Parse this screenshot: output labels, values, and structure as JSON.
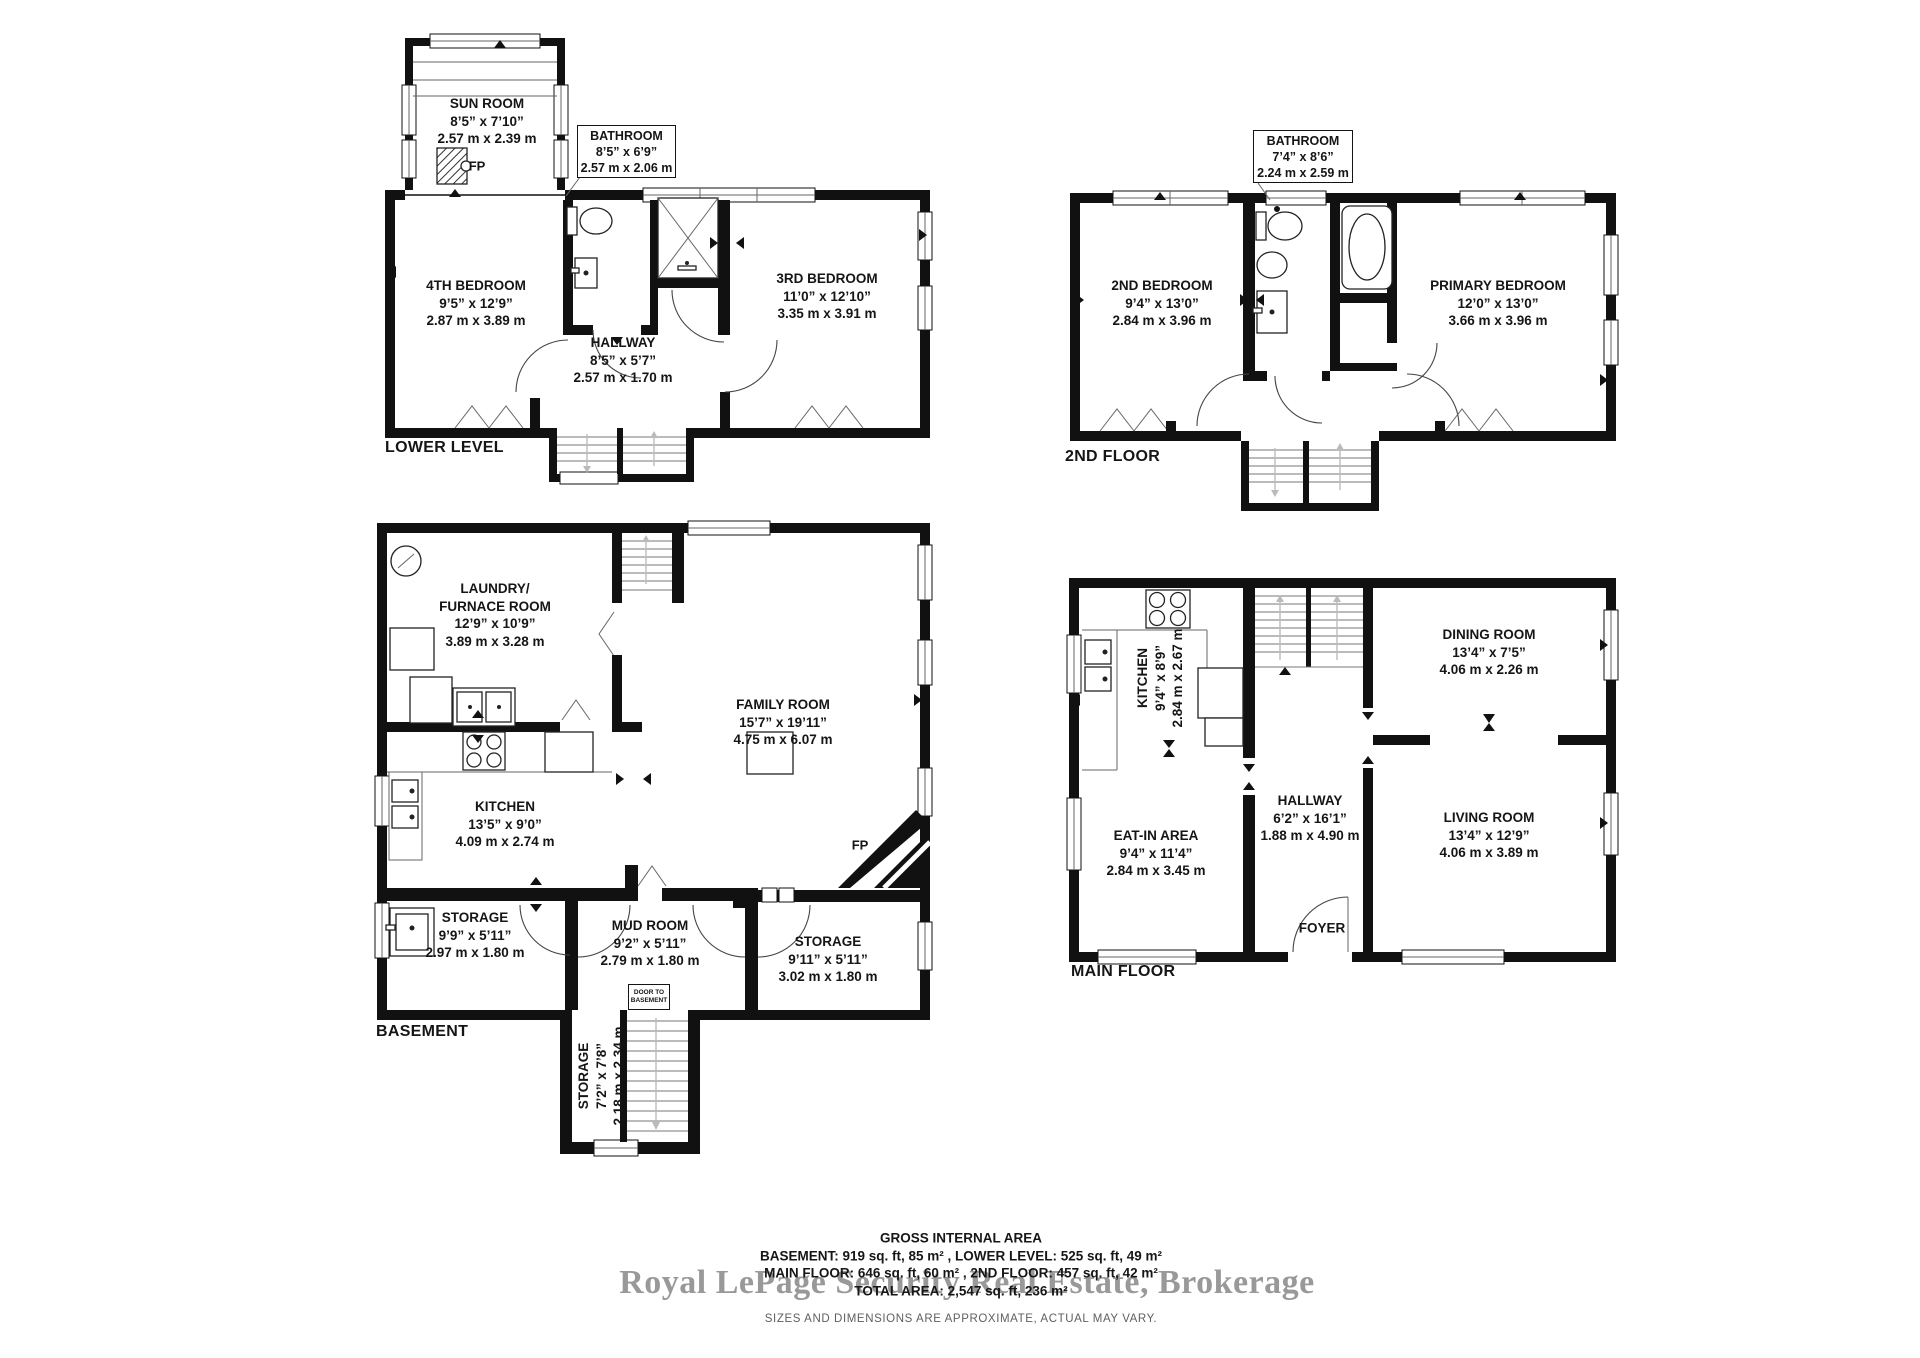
{
  "plans": {
    "lower_level": {
      "title": "LOWER LEVEL",
      "fp_label": "FP",
      "rooms": {
        "sun_room": {
          "name": "SUN ROOM",
          "imperial": "8’5” x 7’10”",
          "metric": "2.57 m x 2.39 m"
        },
        "bathroom_callout": {
          "name": "BATHROOM",
          "imperial": "8’5” x 6’9”",
          "metric": "2.57 m x 2.06 m"
        },
        "bedroom4": {
          "name": "4TH BEDROOM",
          "imperial": "9’5” x 12’9”",
          "metric": "2.87 m x 3.89 m"
        },
        "hallway": {
          "name": "HALLWAY",
          "imperial": "8’5” x 5’7”",
          "metric": "2.57 m x 1.70 m"
        },
        "bedroom3": {
          "name": "3RD BEDROOM",
          "imperial": "11’0” x 12’10”",
          "metric": "3.35 m x 3.91 m"
        }
      }
    },
    "second_floor": {
      "title": "2ND FLOOR",
      "rooms": {
        "bathroom_callout": {
          "name": "BATHROOM",
          "imperial": "7’4” x 8’6”",
          "metric": "2.24 m x 2.59 m"
        },
        "bedroom2": {
          "name": "2ND BEDROOM",
          "imperial": "9’4” x 13’0”",
          "metric": "2.84 m x 3.96 m"
        },
        "primary": {
          "name": "PRIMARY BEDROOM",
          "imperial": "12’0” x 13’0”",
          "metric": "3.66 m x 3.96 m"
        }
      }
    },
    "basement": {
      "title": "BASEMENT",
      "fp_label": "FP",
      "door_note_line1": "DOOR TO",
      "door_note_line2": "BASEMENT",
      "rooms": {
        "laundry": {
          "name1": "LAUNDRY/",
          "name2": "FURNACE ROOM",
          "imperial": "12’9” x 10’9”",
          "metric": "3.89 m x 3.28 m"
        },
        "family": {
          "name": "FAMILY ROOM",
          "imperial": "15’7” x 19’11”",
          "metric": "4.75 m x 6.07 m"
        },
        "kitchen": {
          "name": "KITCHEN",
          "imperial": "13’5” x 9’0”",
          "metric": "4.09 m x 2.74 m"
        },
        "storage_left": {
          "name": "STORAGE",
          "imperial": "9’9” x 5’11”",
          "metric": "2.97 m x 1.80 m"
        },
        "mud_room": {
          "name": "MUD ROOM",
          "imperial": "9’2” x 5’11”",
          "metric": "2.79 m x 1.80 m"
        },
        "storage_right": {
          "name": "STORAGE",
          "imperial": "9’11” x 5’11”",
          "metric": "3.02 m x 1.80 m"
        },
        "storage_bottom": {
          "name": "STORAGE",
          "imperial": "7’2” x 7’8”",
          "metric": "2.18 m x 2.34 m"
        }
      }
    },
    "main_floor": {
      "title": "MAIN FLOOR",
      "rooms": {
        "kitchen": {
          "name": "KITCHEN",
          "imperial": "9’4” x 8’9”",
          "metric": "2.84 m x 2.67 m"
        },
        "dining": {
          "name": "DINING ROOM",
          "imperial": "13’4” x 7’5”",
          "metric": "4.06 m x 2.26 m"
        },
        "hallway": {
          "name": "HALLWAY",
          "imperial": "6’2” x 16’1”",
          "metric": "1.88 m x 4.90 m"
        },
        "eat_in": {
          "name": "EAT-IN AREA",
          "imperial": "9’4” x 11’4”",
          "metric": "2.84 m x 3.45 m"
        },
        "living": {
          "name": "LIVING ROOM",
          "imperial": "13’4” x 12’9”",
          "metric": "4.06 m x 3.89 m"
        },
        "foyer": {
          "name": "FOYER"
        }
      }
    }
  },
  "footer": {
    "title": "GROSS INTERNAL AREA",
    "line1": "BASEMENT: 919 sq. ft, 85 m² , LOWER LEVEL: 525 sq. ft, 49 m²",
    "line2": "MAIN FLOOR: 646 sq. ft, 60 m² , 2ND FLOOR: 457 sq. ft, 42 m²",
    "line3": "TOTAL AREA: 2,547 sq. ft, 236 m²",
    "watermark": "Royal LePage Security Real Estate, Brokerage",
    "disclaimer": "SIZES AND DIMENSIONS ARE APPROXIMATE, ACTUAL MAY VARY."
  }
}
